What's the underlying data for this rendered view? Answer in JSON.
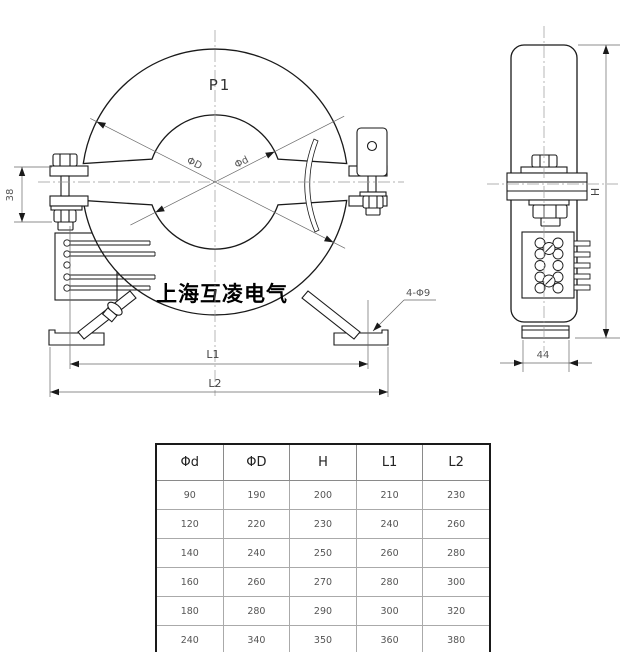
{
  "drawing": {
    "labels": {
      "p1": "P1",
      "outer_dia": "ΦD",
      "inner_dia": "Φd",
      "clamp_height": "38",
      "side_depth": "44",
      "height": "H",
      "l1": "L1",
      "l2": "L2",
      "holes": "4-Φ9",
      "brand": "上海互凌电气"
    },
    "line_color": "#1a1a1a",
    "dim_color": "#555555"
  },
  "table": {
    "headers": [
      "Φd",
      "ΦD",
      "H",
      "L1",
      "L2"
    ],
    "rows": [
      [
        "90",
        "190",
        "200",
        "210",
        "230"
      ],
      [
        "120",
        "220",
        "230",
        "240",
        "260"
      ],
      [
        "140",
        "240",
        "250",
        "260",
        "280"
      ],
      [
        "160",
        "260",
        "270",
        "280",
        "300"
      ],
      [
        "180",
        "280",
        "290",
        "300",
        "320"
      ],
      [
        "240",
        "340",
        "350",
        "360",
        "380"
      ]
    ]
  }
}
